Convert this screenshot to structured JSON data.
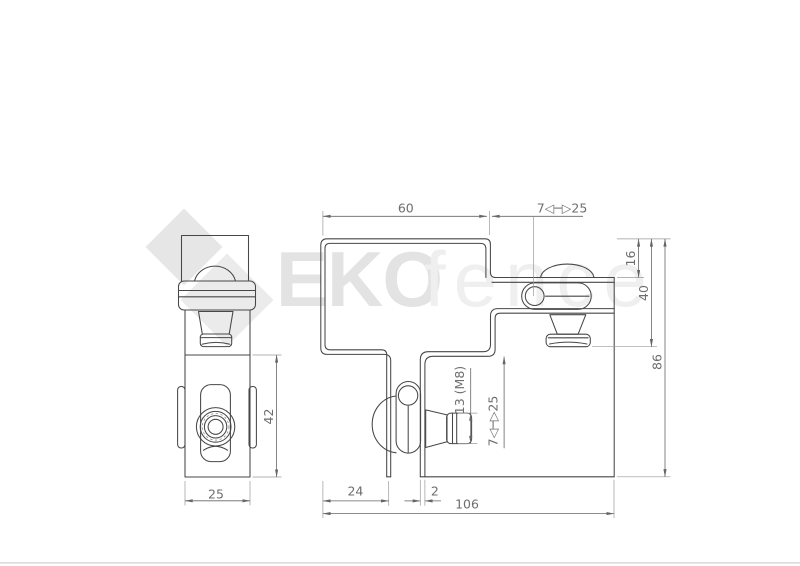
{
  "watermark": {
    "logo": "eko-diamond-logo",
    "brand_bold": "EKO",
    "brand_light": "fence"
  },
  "colors": {
    "line": "#474747",
    "dimension": "#666666",
    "dim_text": "#6e6e6e",
    "watermark_bold": "#e3e3e3",
    "watermark_light": "#efefef",
    "logo_diamond_dark": "#e6e6e6",
    "logo_diamond_light": "#ebebeb",
    "bottom_border": "#dcdcdc"
  },
  "side_view": {
    "width": "25",
    "height": "42"
  },
  "front_view": {
    "top_width": "60",
    "top_range": "7◁─▷25",
    "top_offset": "16",
    "mid_depth": "40",
    "overall_height": "86",
    "nut_size": "13 (M8)",
    "side_range": "7◁─▷25",
    "leg_offset": "24",
    "sheet_thickness": "2",
    "overall_width": "106"
  }
}
